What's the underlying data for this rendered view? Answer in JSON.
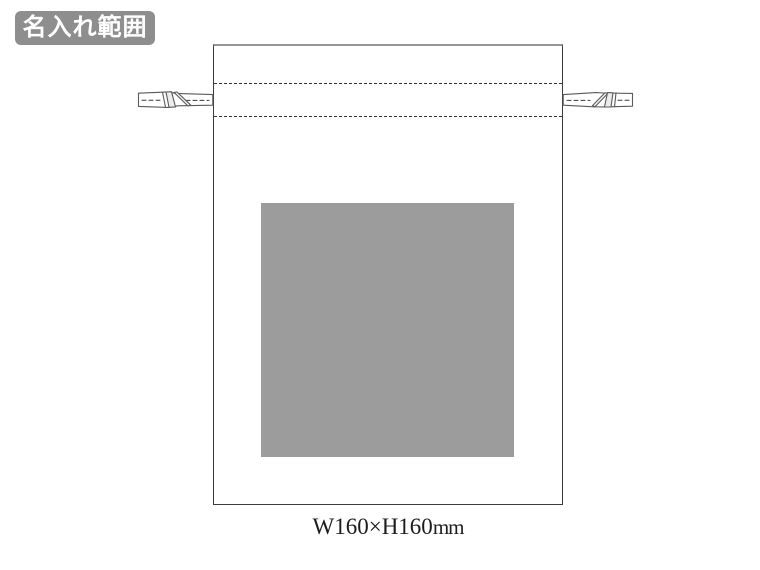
{
  "badge": {
    "label": "名入れ範囲",
    "background": "#8e8e8e",
    "text_color": "#ffffff"
  },
  "bag": {
    "fill": "#ffffff",
    "outline_color": "#3c3c3c",
    "top_edge_color": "#979797",
    "stitch_line_color": "#333333",
    "cord_outline_color": "#5a5a5a"
  },
  "print_area": {
    "fill": "#9c9c9c"
  },
  "caption": {
    "dimensions": "W160×H160",
    "unit": "mm"
  },
  "icons": {
    "left_cord": "drawstring-cord-left-icon",
    "right_cord": "drawstring-cord-right-icon"
  }
}
